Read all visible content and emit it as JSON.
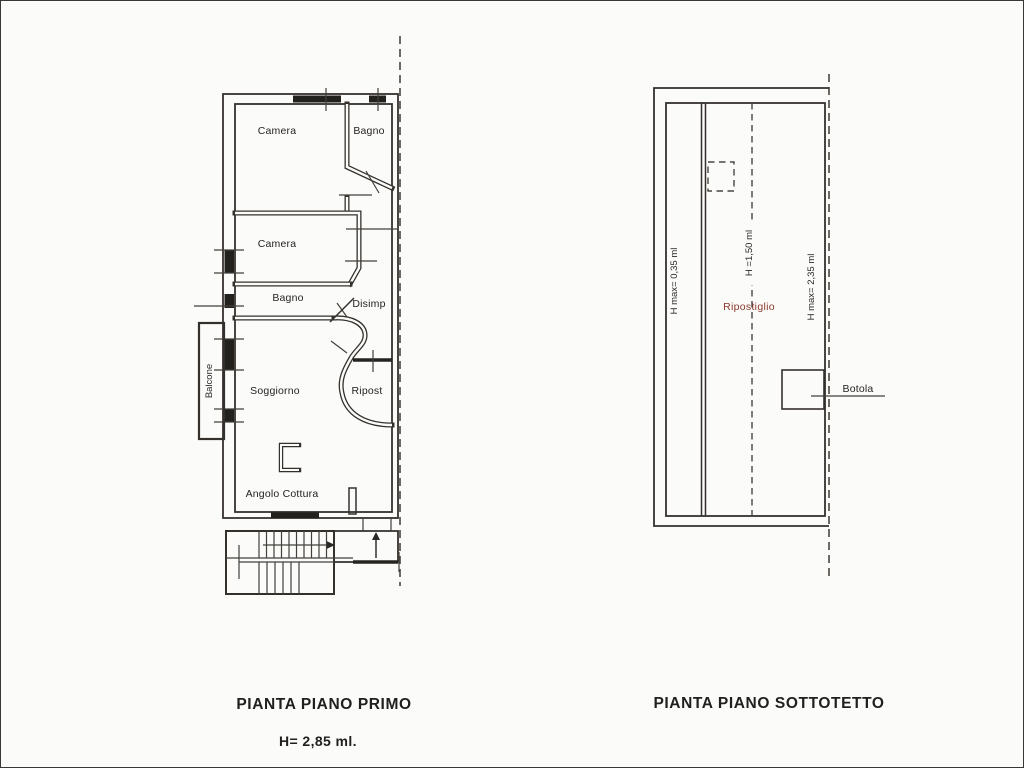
{
  "document": {
    "background": "#fbfbf9",
    "ink_color": "#34312d",
    "accent_room_color": "#8a392c"
  },
  "plan_primo": {
    "caption": "PIANTA PIANO PRIMO",
    "height_note": "H= 2,85 ml.",
    "rooms": {
      "camera1": "Camera",
      "bagno1": "Bagno",
      "camera2": "Camera",
      "bagno2": "Bagno",
      "disimp": "Disimp",
      "soggiorno": "Soggiorno",
      "ripost": "Ripost",
      "angolo_cottura": "Angolo Cottura",
      "balcone": "Balcone"
    }
  },
  "plan_sottotetto": {
    "caption": "PIANTA PIANO SOTTOTETTO",
    "labels": {
      "h_left": "H max= 0,35 ml",
      "h_ridge": "H =1,50 ml",
      "h_right": "H max= 2,35 ml",
      "ripostiglio": "Ripostiglio",
      "botola": "Botola"
    }
  }
}
